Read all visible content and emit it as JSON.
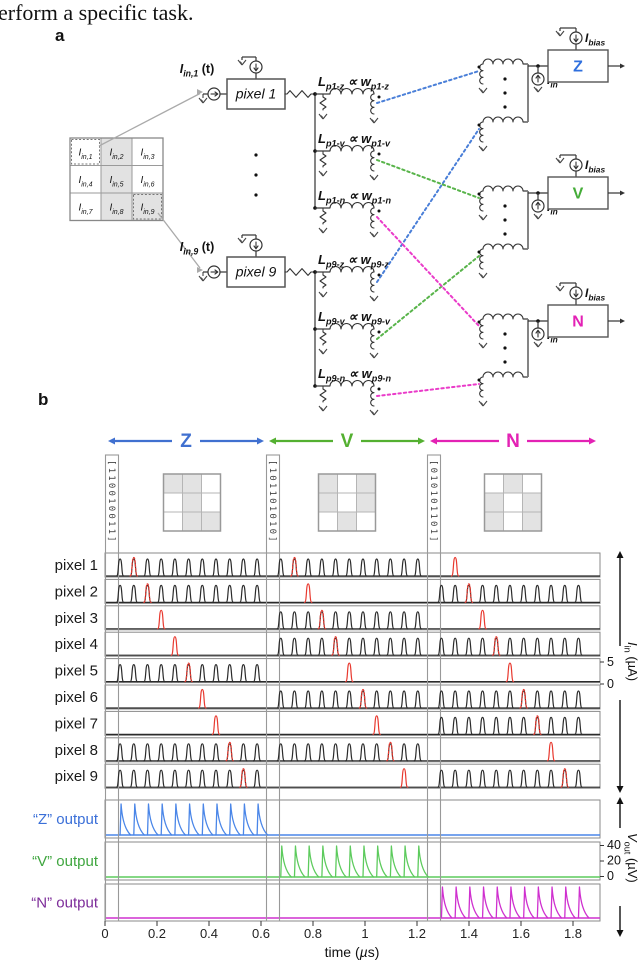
{
  "page": {
    "top_text": "erform a specific task.",
    "panel_a_label": "a",
    "panel_b_label": "b"
  },
  "panel_a": {
    "labels": {
      "L": "L",
      "prop": "∝",
      "w": "w",
      "bias_base": "I",
      "bias_sub": "bias",
      "iin_base": "I",
      "iin_sub": "in"
    },
    "input_grid": {
      "cells": [
        {
          "base": "I",
          "sub": "in,1",
          "shaded": false,
          "dotted": true
        },
        {
          "base": "I",
          "sub": "in,2",
          "shaded": true,
          "dotted": false
        },
        {
          "base": "I",
          "sub": "in,3",
          "shaded": false,
          "dotted": false
        },
        {
          "base": "I",
          "sub": "in,4",
          "shaded": false,
          "dotted": false
        },
        {
          "base": "I",
          "sub": "in,5",
          "shaded": true,
          "dotted": false
        },
        {
          "base": "I",
          "sub": "in,6",
          "shaded": false,
          "dotted": false
        },
        {
          "base": "I",
          "sub": "in,7",
          "shaded": false,
          "dotted": false
        },
        {
          "base": "I",
          "sub": "in,8",
          "shaded": true,
          "dotted": false
        },
        {
          "base": "I",
          "sub": "in,9",
          "shaded": true,
          "dotted": true
        }
      ]
    },
    "pixels": [
      {
        "name": "pixel 1",
        "input_base": "I",
        "input_sub": "in,1",
        "input_suffix": " (t)",
        "branches": [
          {
            "L": "p1-z",
            "w": "p1-z"
          },
          {
            "L": "p1-v",
            "w": "p1-v"
          },
          {
            "L": "p1-n",
            "w": "p1-n"
          }
        ]
      },
      {
        "name": "pixel 9",
        "input_base": "I",
        "input_sub": "in,9",
        "input_suffix": " (t)",
        "branches": [
          {
            "L": "p9-z",
            "w": "p9-z"
          },
          {
            "L": "p9-v",
            "w": "p9-v"
          },
          {
            "L": "p9-n",
            "w": "p9-n"
          }
        ]
      }
    ],
    "units": [
      {
        "name": "Z",
        "letter_color": "#2f6fde",
        "wire_color": "#4a7fd8"
      },
      {
        "name": "V",
        "letter_color": "#44ac38",
        "wire_color": "#58b44a"
      },
      {
        "name": "N",
        "letter_color": "#e321b5",
        "wire_color": "#ea3bc9"
      }
    ]
  },
  "chart_data": {
    "type": "line",
    "xlabel": "time (µs)",
    "x_ticks": [
      0,
      0.2,
      0.4,
      0.6,
      0.8,
      1,
      1.2,
      1.4,
      1.6,
      1.8
    ],
    "x_range_us": [
      0,
      1.9
    ],
    "pixel_rows": [
      "pixel 1",
      "pixel 2",
      "pixel 3",
      "pixel 4",
      "pixel 5",
      "pixel 6",
      "pixel 7",
      "pixel 8",
      "pixel 9"
    ],
    "input_axis": {
      "label_base": "I",
      "label_sub": "in",
      "label_unit": " (µA)",
      "ticks": [
        5,
        0
      ]
    },
    "output_axis": {
      "label_base": "V",
      "label_sub": "out",
      "label_unit": " (µV)",
      "ticks": [
        40,
        20,
        0
      ]
    },
    "pulse": {
      "n_slots": 11,
      "slot_dt_us": 0.0527,
      "amplitude_uA": 5,
      "color": "#2b2b2b"
    },
    "red_pulse": {
      "color": "#e8392f",
      "slots_per_pixel": [
        1,
        2,
        3,
        4,
        5,
        6,
        7,
        8,
        9
      ]
    },
    "sections": [
      {
        "name": "Z",
        "color": "#4070d0",
        "binary": "[110010011]",
        "pattern": [
          1,
          1,
          0,
          0,
          1,
          0,
          0,
          1,
          1
        ],
        "start_us": 0.058
      },
      {
        "name": "V",
        "color": "#54b031",
        "binary": "[101101010]",
        "pattern": [
          1,
          0,
          1,
          1,
          0,
          1,
          0,
          1,
          0
        ],
        "start_us": 0.676
      },
      {
        "name": "N",
        "color": "#e322b4",
        "binary": "[010101101]",
        "pattern": [
          0,
          1,
          0,
          1,
          0,
          1,
          1,
          0,
          1
        ],
        "start_us": 1.294
      }
    ],
    "outputs": [
      {
        "label": "“Z” output",
        "label_color": "#3a6fd8",
        "wave_color": "#4a86e8",
        "section": "Z",
        "peak_uV": 40
      },
      {
        "label": "“V” output",
        "label_color": "#3fa63f",
        "wave_color": "#5dcb5d",
        "section": "V",
        "peak_uV": 40
      },
      {
        "label": "“N” output",
        "label_color": "#7c2b99",
        "wave_color": "#cf30cf",
        "section": "N",
        "peak_uV": 40
      }
    ]
  }
}
